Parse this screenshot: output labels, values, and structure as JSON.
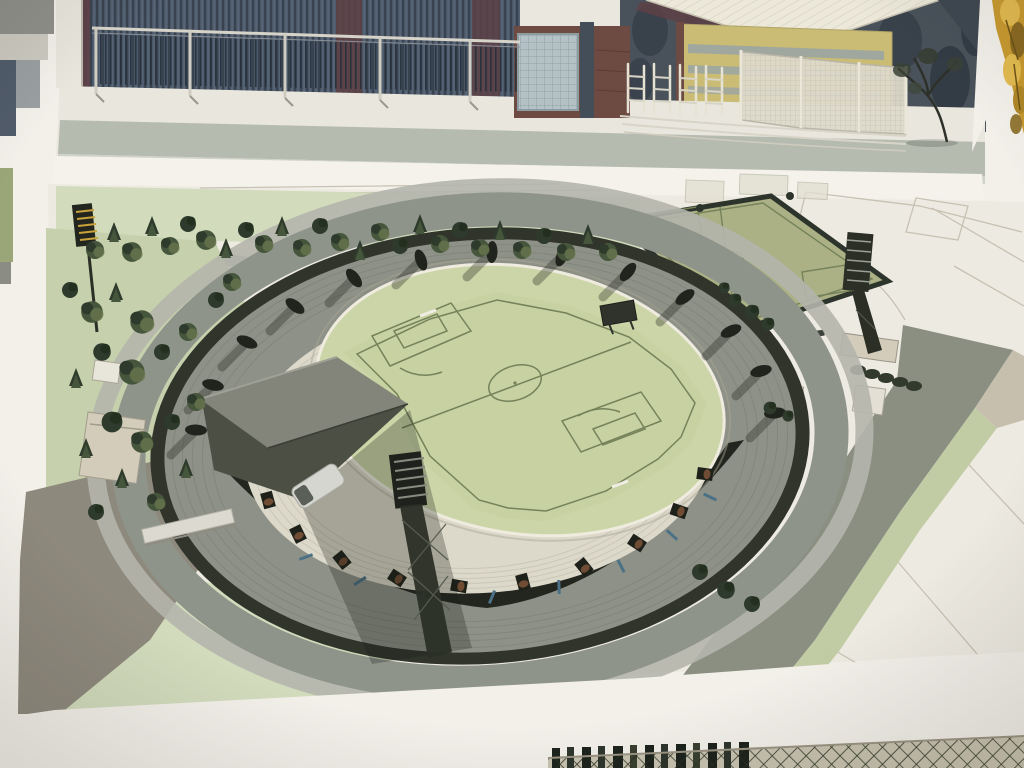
{
  "image_type": "photograph-of-sign-board",
  "subject": "architectural renderings of a football stadium development",
  "panels": {
    "top": {
      "name": "street-level-view",
      "elements": [
        "curtain-wall-building",
        "metal-railing",
        "glass-block-wall",
        "v-shaped-canopy-roof",
        "yellow-building",
        "turnstile-gates",
        "mesh-fence-panels",
        "street-tree",
        "sidewalk",
        "road"
      ]
    },
    "main": {
      "name": "aerial-stadium-rendering",
      "elements": [
        "stadium-bowl",
        "soccer-pitch",
        "roof-canopy-wedge",
        "floodlight-towers",
        "practice-pitch",
        "park-trees",
        "ring-road",
        "plaza",
        "parked-cars",
        "service-van",
        "site-plan-lines"
      ]
    }
  },
  "counts": {
    "upper-tier-vomitories": 13,
    "lower-bowl-seat-blocks": 10,
    "floodlight-towers": 3,
    "mesh-fence-panels": 3,
    "turnstile-gates": 4
  },
  "colors": {
    "sign-white": "#f2f0e9",
    "panel-bg": "#eae7de",
    "art-bg": "#edeae1",
    "wall-blue": "#4d5a6c",
    "maroon": "#5d4146",
    "glass": "#b4c1c6",
    "brick": "#6d4b43",
    "roof-cream": "#ece8da",
    "yellow-bldg": "#cabc75",
    "window-band": "#9aa4a3",
    "fence-cream": "#ddd9ca",
    "road-top": "#b6bbb0",
    "sidewalk": "#e9e6dd",
    "divider": "#f4f2eb",
    "lawn": "#d2dbbc",
    "lawn2": "#c6d0ac",
    "road-gray": "#a0a298",
    "plaza": "#8e897d",
    "ring-road": "#8f948b",
    "walkway": "#b4b5ac",
    "rim-dark": "#31342b",
    "tier-gray": "#8e9187",
    "tier-line": "#7c7f73",
    "south-band": "#23261e",
    "bowl-white": "#dcd8ca",
    "bowl-line": "#c7c3b5",
    "apron": "#ccd5a8",
    "pitch": "#c7d1a2",
    "practice": "#abb185",
    "pitch-line": "#75825a",
    "hedge": "#2d342b",
    "roof-light": "#83857a",
    "roof-dark": "#4b4f44",
    "tower-dark": "#2b2f26",
    "tree-dark": "#2e3a2b",
    "tree-mid": "#46563c",
    "tree-olive": "#66754e",
    "brown-seat": "#6f4c33",
    "blue-stair": "#4b7186",
    "beige-bldg": "#d3ccba",
    "tan": "#c6bfae",
    "site-line": "#c3bdae",
    "fence-bg": "#c9c3b1",
    "mesh": "#2a3222",
    "slat": "#1d231c",
    "foliage1": "#c99a30",
    "foliage2": "#e3bb50",
    "foliage3": "#8a6a22"
  }
}
